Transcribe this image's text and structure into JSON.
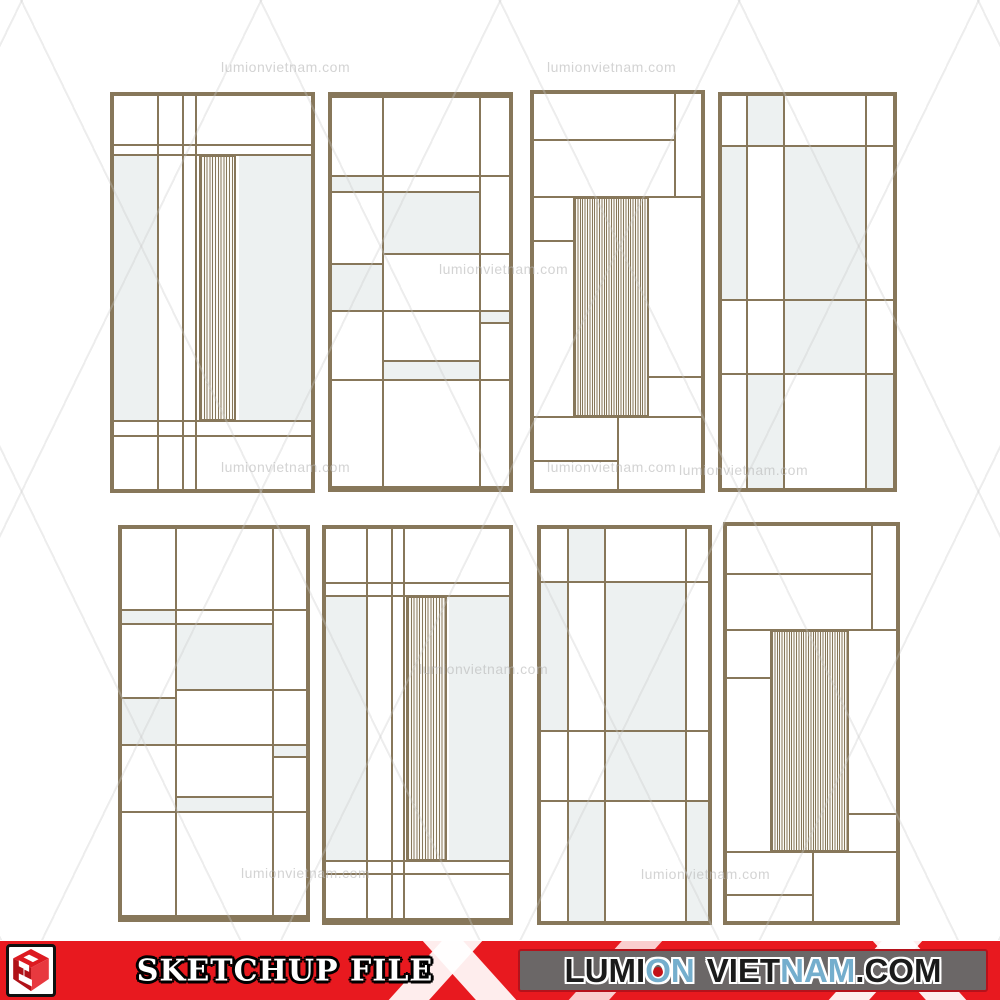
{
  "colors": {
    "frame": "#87775a",
    "tint": "#edf1f1",
    "red": "#e8191f",
    "graybox": "#6b6767",
    "wm": "#b9b9b9",
    "letter_dark": "#1b1b1b",
    "letter_blue": "#74aecd"
  },
  "watermark_text": "lumionvietnam.com",
  "watermarks": [
    {
      "x": 221,
      "y": 59
    },
    {
      "x": 547,
      "y": 59
    },
    {
      "x": 439,
      "y": 261
    },
    {
      "x": 221,
      "y": 459
    },
    {
      "x": 547,
      "y": 459
    },
    {
      "x": 679,
      "y": 462
    },
    {
      "x": 419,
      "y": 661
    },
    {
      "x": 241,
      "y": 865
    },
    {
      "x": 641,
      "y": 866
    }
  ],
  "panels": [
    {
      "id": 1,
      "x": 110,
      "y": 92,
      "w": 205,
      "h": 401,
      "ft": 4,
      "fr": 4,
      "fb": 4,
      "fl": 4,
      "vlines": [
        {
          "x": 22.4
        },
        {
          "x": 34.8
        },
        {
          "x": 41.6
        }
      ],
      "hlines": [
        {
          "y": 12.5
        },
        {
          "y": 15.0
        },
        {
          "y": 82.8
        },
        {
          "y": 86.5
        }
      ],
      "tints": [
        {
          "x": 0,
          "y": 15,
          "w": 22.4,
          "h": 67.8
        },
        {
          "x": 63.2,
          "y": 15,
          "w": 36.8,
          "h": 67.8
        }
      ],
      "slats": [
        {
          "x": 43.2,
          "y": 15,
          "w": 18.6,
          "h": 67.8,
          "pitch": 2.8
        }
      ]
    },
    {
      "id": 2,
      "x": 328,
      "y": 92,
      "w": 185,
      "h": 400,
      "ft": 6,
      "fr": 4,
      "fb": 6,
      "fl": 4,
      "vlines": [
        {
          "x": 28.6
        },
        {
          "x": 83.8
        }
      ],
      "hlines": [
        {
          "y": 20.2
        },
        {
          "y": 24.3,
          "x1": 0,
          "x2": 83.8
        },
        {
          "y": 40.3,
          "x1": 28.6,
          "x2": 100
        },
        {
          "y": 42.9,
          "x1": 0,
          "x2": 28.6
        },
        {
          "y": 54.9
        },
        {
          "y": 58.1,
          "x1": 83.8,
          "x2": 100
        },
        {
          "y": 67.9,
          "x1": 28.6,
          "x2": 83.8
        },
        {
          "y": 72.7
        }
      ],
      "tints": [
        {
          "x": 0,
          "y": 20.2,
          "w": 28.6,
          "h": 4.1
        },
        {
          "x": 28.6,
          "y": 24.3,
          "w": 55.2,
          "h": 16.0
        },
        {
          "x": 0,
          "y": 42.9,
          "w": 28.6,
          "h": 12.0
        },
        {
          "x": 83.8,
          "y": 54.9,
          "w": 16.2,
          "h": 3.2
        },
        {
          "x": 28.6,
          "y": 67.9,
          "w": 55.2,
          "h": 4.8
        }
      ],
      "slats": []
    },
    {
      "id": 3,
      "x": 530,
      "y": 90,
      "w": 175,
      "h": 403,
      "ft": 4,
      "fr": 4,
      "fb": 4,
      "fl": 4,
      "vlines": [
        {
          "x": 84.6,
          "y1": 0,
          "y2": 26
        },
        {
          "x": 50.5,
          "y1": 81.8,
          "y2": 100
        }
      ],
      "hlines": [
        {
          "y": 11.7,
          "x1": 0,
          "x2": 84.6
        },
        {
          "y": 26.0
        },
        {
          "y": 37.3,
          "x1": 0,
          "x2": 23.4
        },
        {
          "y": 71.6,
          "x1": 69,
          "x2": 100
        },
        {
          "y": 81.8
        },
        {
          "y": 93.0,
          "x1": 0,
          "x2": 50.5
        }
      ],
      "tints": [],
      "slats": [
        {
          "x": 23.4,
          "y": 26,
          "w": 45.6,
          "h": 55.8,
          "pitch": 2.4
        }
      ]
    },
    {
      "id": 4,
      "x": 718,
      "y": 92,
      "w": 179,
      "h": 400,
      "ft": 4,
      "fr": 4,
      "fb": 4,
      "fl": 4,
      "vlines": [
        {
          "x": 14.5
        },
        {
          "x": 36
        },
        {
          "x": 84
        }
      ],
      "hlines": [
        {
          "y": 12.7
        },
        {
          "y": 52
        },
        {
          "y": 70.8
        }
      ],
      "tints": [
        {
          "x": 14.5,
          "y": 0,
          "w": 21.5,
          "h": 12.7
        },
        {
          "x": 0,
          "y": 12.7,
          "w": 14.5,
          "h": 39.3
        },
        {
          "x": 36,
          "y": 12.7,
          "w": 48,
          "h": 39.3
        },
        {
          "x": 36,
          "y": 52,
          "w": 48,
          "h": 18.8
        },
        {
          "x": 14.5,
          "y": 70.8,
          "w": 21.5,
          "h": 29.2
        },
        {
          "x": 84,
          "y": 70.8,
          "w": 16,
          "h": 29.2
        }
      ],
      "slats": []
    },
    {
      "id": 5,
      "x": 118,
      "y": 525,
      "w": 192,
      "h": 397,
      "ft": 4,
      "fr": 4,
      "fb": 7,
      "fl": 4,
      "vlines": [
        {
          "x": 29.2
        },
        {
          "x": 82.3
        }
      ],
      "hlines": [
        {
          "y": 21.1
        },
        {
          "y": 24.7,
          "x1": 0,
          "x2": 82.3
        },
        {
          "y": 41.8,
          "x1": 29.2,
          "x2": 100
        },
        {
          "y": 43.9,
          "x1": 0,
          "x2": 29.2
        },
        {
          "y": 55.9
        },
        {
          "y": 59.0,
          "x1": 82.3,
          "x2": 100
        },
        {
          "y": 69.5,
          "x1": 29.2,
          "x2": 82.3
        },
        {
          "y": 73.4
        }
      ],
      "tints": [
        {
          "x": 0,
          "y": 21.1,
          "w": 29.2,
          "h": 3.6
        },
        {
          "x": 29.2,
          "y": 24.7,
          "w": 53.1,
          "h": 17.1
        },
        {
          "x": 0,
          "y": 43.9,
          "w": 29.2,
          "h": 12.0
        },
        {
          "x": 82.3,
          "y": 55.9,
          "w": 17.7,
          "h": 3.1
        },
        {
          "x": 29.2,
          "y": 69.5,
          "w": 53.1,
          "h": 3.9
        }
      ],
      "slats": []
    },
    {
      "id": 6,
      "x": 322,
      "y": 525,
      "w": 191,
      "h": 400,
      "ft": 4,
      "fr": 4,
      "fb": 7,
      "fl": 4,
      "vlines": [
        {
          "x": 22.5
        },
        {
          "x": 36.1
        },
        {
          "x": 42.5
        }
      ],
      "hlines": [
        {
          "y": 13.9
        },
        {
          "y": 17.2
        },
        {
          "y": 85.3
        },
        {
          "y": 88.6
        }
      ],
      "tints": [
        {
          "x": 0,
          "y": 17.2,
          "w": 22.5,
          "h": 68.1
        },
        {
          "x": 67,
          "y": 17.2,
          "w": 33,
          "h": 68.1
        }
      ],
      "slats": [
        {
          "x": 43.5,
          "y": 17.2,
          "w": 22.5,
          "h": 68.1,
          "pitch": 2.8
        }
      ]
    },
    {
      "id": 7,
      "x": 537,
      "y": 525,
      "w": 175,
      "h": 400,
      "ft": 4,
      "fr": 4,
      "fb": 4,
      "fl": 4,
      "vlines": [
        {
          "x": 16
        },
        {
          "x": 38.5
        },
        {
          "x": 87
        }
      ],
      "hlines": [
        {
          "y": 13.4
        },
        {
          "y": 51.6
        },
        {
          "y": 69.5
        }
      ],
      "tints": [
        {
          "x": 16,
          "y": 0,
          "w": 22.5,
          "h": 13.4
        },
        {
          "x": 0,
          "y": 13.4,
          "w": 16,
          "h": 38.2
        },
        {
          "x": 38.5,
          "y": 13.4,
          "w": 48.5,
          "h": 38.2
        },
        {
          "x": 38.5,
          "y": 51.6,
          "w": 48.5,
          "h": 17.9
        },
        {
          "x": 16,
          "y": 69.5,
          "w": 22.5,
          "h": 30.5
        },
        {
          "x": 87,
          "y": 69.5,
          "w": 13,
          "h": 30.5
        }
      ],
      "slats": []
    },
    {
      "id": 8,
      "x": 723,
      "y": 522,
      "w": 177,
      "h": 403,
      "ft": 4,
      "fr": 4,
      "fb": 4,
      "fl": 4,
      "vlines": [
        {
          "x": 86,
          "y1": 0,
          "y2": 26.4
        },
        {
          "x": 51,
          "y1": 82.5,
          "y2": 100
        }
      ],
      "hlines": [
        {
          "y": 12.2,
          "x1": 0,
          "x2": 86
        },
        {
          "y": 26.4
        },
        {
          "y": 38.5,
          "x1": 0,
          "x2": 25.4
        },
        {
          "y": 73.0,
          "x1": 72,
          "x2": 100
        },
        {
          "y": 82.5
        },
        {
          "y": 93.5,
          "x1": 0,
          "x2": 51
        }
      ],
      "tints": [],
      "slats": [
        {
          "x": 25.4,
          "y": 26.4,
          "w": 46.6,
          "h": 56.1,
          "pitch": 2.4
        }
      ]
    }
  ],
  "footer": {
    "sketchup_label": "SKETCHUP FILE",
    "site_letters": [
      {
        "ch": "L",
        "color": "dark"
      },
      {
        "ch": "U",
        "color": "dark"
      },
      {
        "ch": "M",
        "color": "dark"
      },
      {
        "ch": "I",
        "color": "dark"
      },
      {
        "ch": "O",
        "color": "blue",
        "dot": true
      },
      {
        "ch": "N",
        "color": "blue"
      },
      {
        "ch": " "
      },
      {
        "ch": "V",
        "color": "dark"
      },
      {
        "ch": "I",
        "color": "dark"
      },
      {
        "ch": "E",
        "color": "dark"
      },
      {
        "ch": "T",
        "color": "dark"
      },
      {
        "ch": "N",
        "color": "blue"
      },
      {
        "ch": "A",
        "color": "blue"
      },
      {
        "ch": "M",
        "color": "blue"
      },
      {
        "ch": ".",
        "color": "dark"
      },
      {
        "ch": "C",
        "color": "dark"
      },
      {
        "ch": "O",
        "color": "dark"
      },
      {
        "ch": "M",
        "color": "dark"
      }
    ]
  }
}
